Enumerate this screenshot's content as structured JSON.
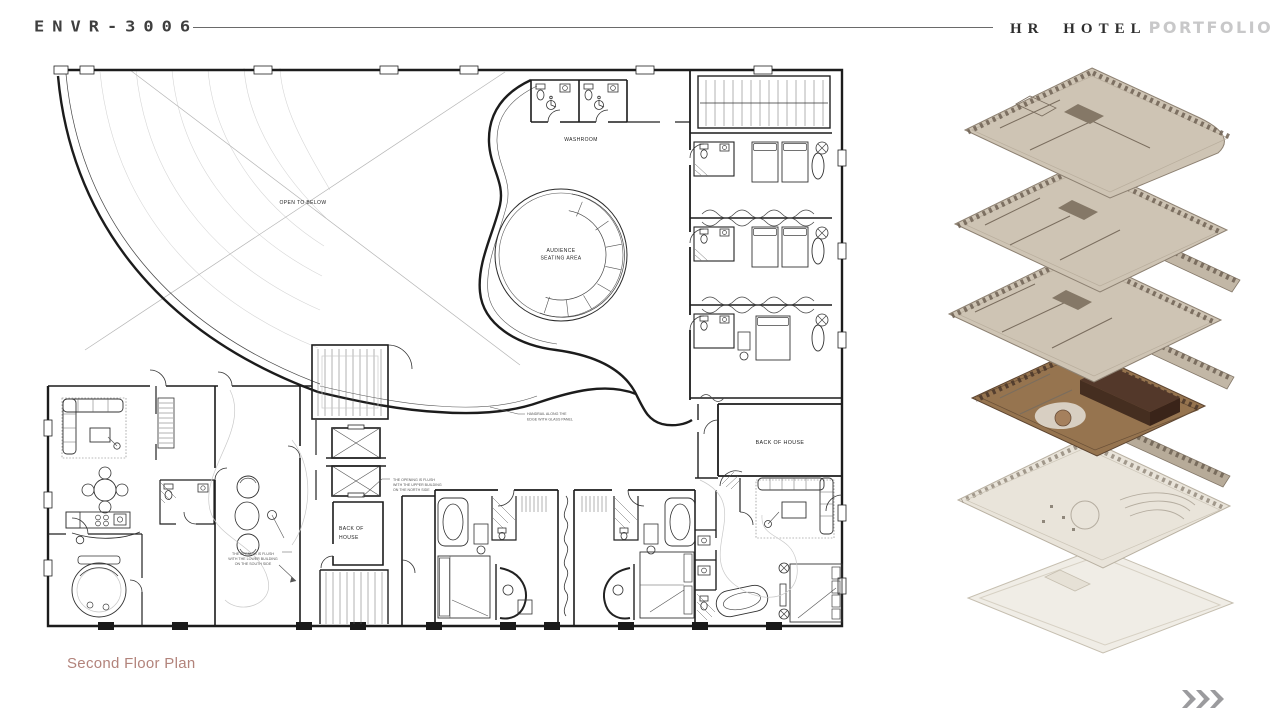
{
  "header": {
    "logo": "ENVR-3006",
    "brand": "HR HOTEL",
    "brand_accent": "PORTFOLIO"
  },
  "plan": {
    "room_labels": {
      "washroom": "WASHROOM",
      "open_to_below": "OPEN TO BELOW",
      "audience_line1": "AUDIENCE",
      "audience_line2": "SEATING AREA",
      "back_of_house_east": "BACK OF HOUSE",
      "back_of_house_core_line1": "BACK OF",
      "back_of_house_core_line2": "HOUSE"
    },
    "annotations": {
      "handrail_line1": "HANDRAIL ALONG THE",
      "handrail_line2": "EDGE WITH GLASS PANEL",
      "opening_north_line1": "THE OPENING IS FLUSH",
      "opening_north_line2": "WITH THE UPPER BUILDING",
      "opening_north_line3": "ON THE NORTH SIDE",
      "opening_south_line1": "THE OPENING IS FLUSH",
      "opening_south_line2": "WITH THE LOWER BUILDING",
      "opening_south_line3": "ON THE SOUTH SIDE"
    }
  },
  "caption": "Second Floor Plan",
  "colors": {
    "caption_text": "#b2837b",
    "brand_accent_text": "#c8c8c9",
    "divider_line": "#6a6a6a",
    "plan_ink": "#1c1c1c",
    "axon_beige": "#cec4b4",
    "axon_wood": "#8d6b4e",
    "axon_dark_brown": "#4a3126",
    "axon_pale": "#e9e4da",
    "chevron_gray": "#9b9b9e"
  }
}
